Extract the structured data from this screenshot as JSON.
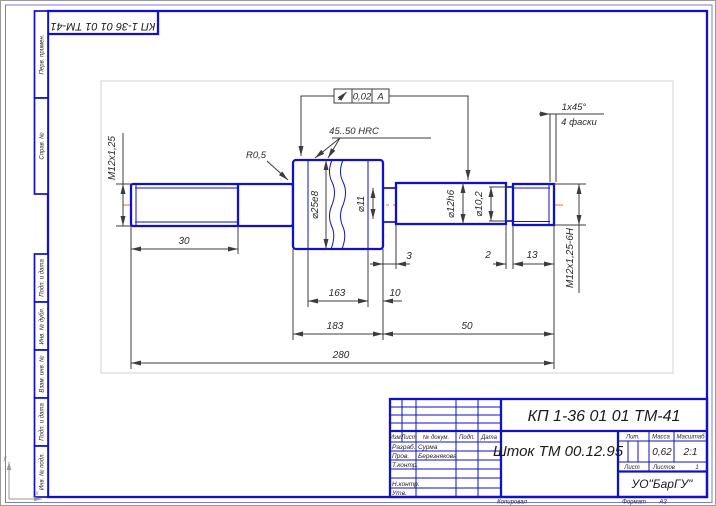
{
  "page": {
    "designation_inverted": "КП 1-36 01 01 ТМ-41",
    "origin_marker": {
      "x_label": "x",
      "y_label": "y"
    }
  },
  "margin_columns": {
    "perv_primen": "Перв. примен.",
    "sprav_no": "Справ. №",
    "podp_data_1": "Подп. и дата",
    "inv_dubl": "Инв. № дубл.",
    "vzam_inv": "Взам. инв. №",
    "podp_data_2": "Подп. и дата",
    "inv_podl": "Инв. № подл."
  },
  "drawing": {
    "thread_left_label": "М12х1,25",
    "fillet_label": "R0,5",
    "hardness_note": "45..50 HRC",
    "tolerance": {
      "value": "0,02",
      "datum": "А"
    },
    "dia_25": "⌀25е8",
    "dia_11": "⌀11",
    "dia_12": "⌀12h6",
    "dia_10_2": "⌀10,2",
    "thread_right_label": "М12х1,25-6Н",
    "chamfer_size": "1х45°",
    "chamfer_note": "4 фаски",
    "len_30": "30",
    "len_163": "163",
    "len_10": "10",
    "len_183": "183",
    "len_50": "50",
    "len_280": "280",
    "len_3": "3",
    "len_2": "2",
    "len_13": "13"
  },
  "title_block": {
    "designation": "КП 1-36 01 01 ТМ-41",
    "part_name": "Шток ТМ 00.12.95",
    "headers": {
      "izm": "Изм.",
      "list": "Лист",
      "n_dokum": "№ докум.",
      "podp": "Подп.",
      "data": "Дата",
      "lit": "Лит.",
      "massa": "Масса",
      "masshtab": "Масштаб",
      "list2": "Лист",
      "listov": "Листов"
    },
    "rows": {
      "razrab_label": "Разраб.",
      "razrab_name": "Сурма",
      "prov_label": "Пров.",
      "prov_name": "Березнякова",
      "t_kontr_label": "Т.контр.",
      "n_kontr_label": "Н.контр.",
      "utv_label": "Утв."
    },
    "massa_value": "0,62",
    "scale_value": "2:1",
    "listov_value": "1",
    "organization": "УО\"БарГУ\"",
    "footer": {
      "kopiroval": "Копировал",
      "format_label": "Формат",
      "format_value": "А3"
    }
  }
}
